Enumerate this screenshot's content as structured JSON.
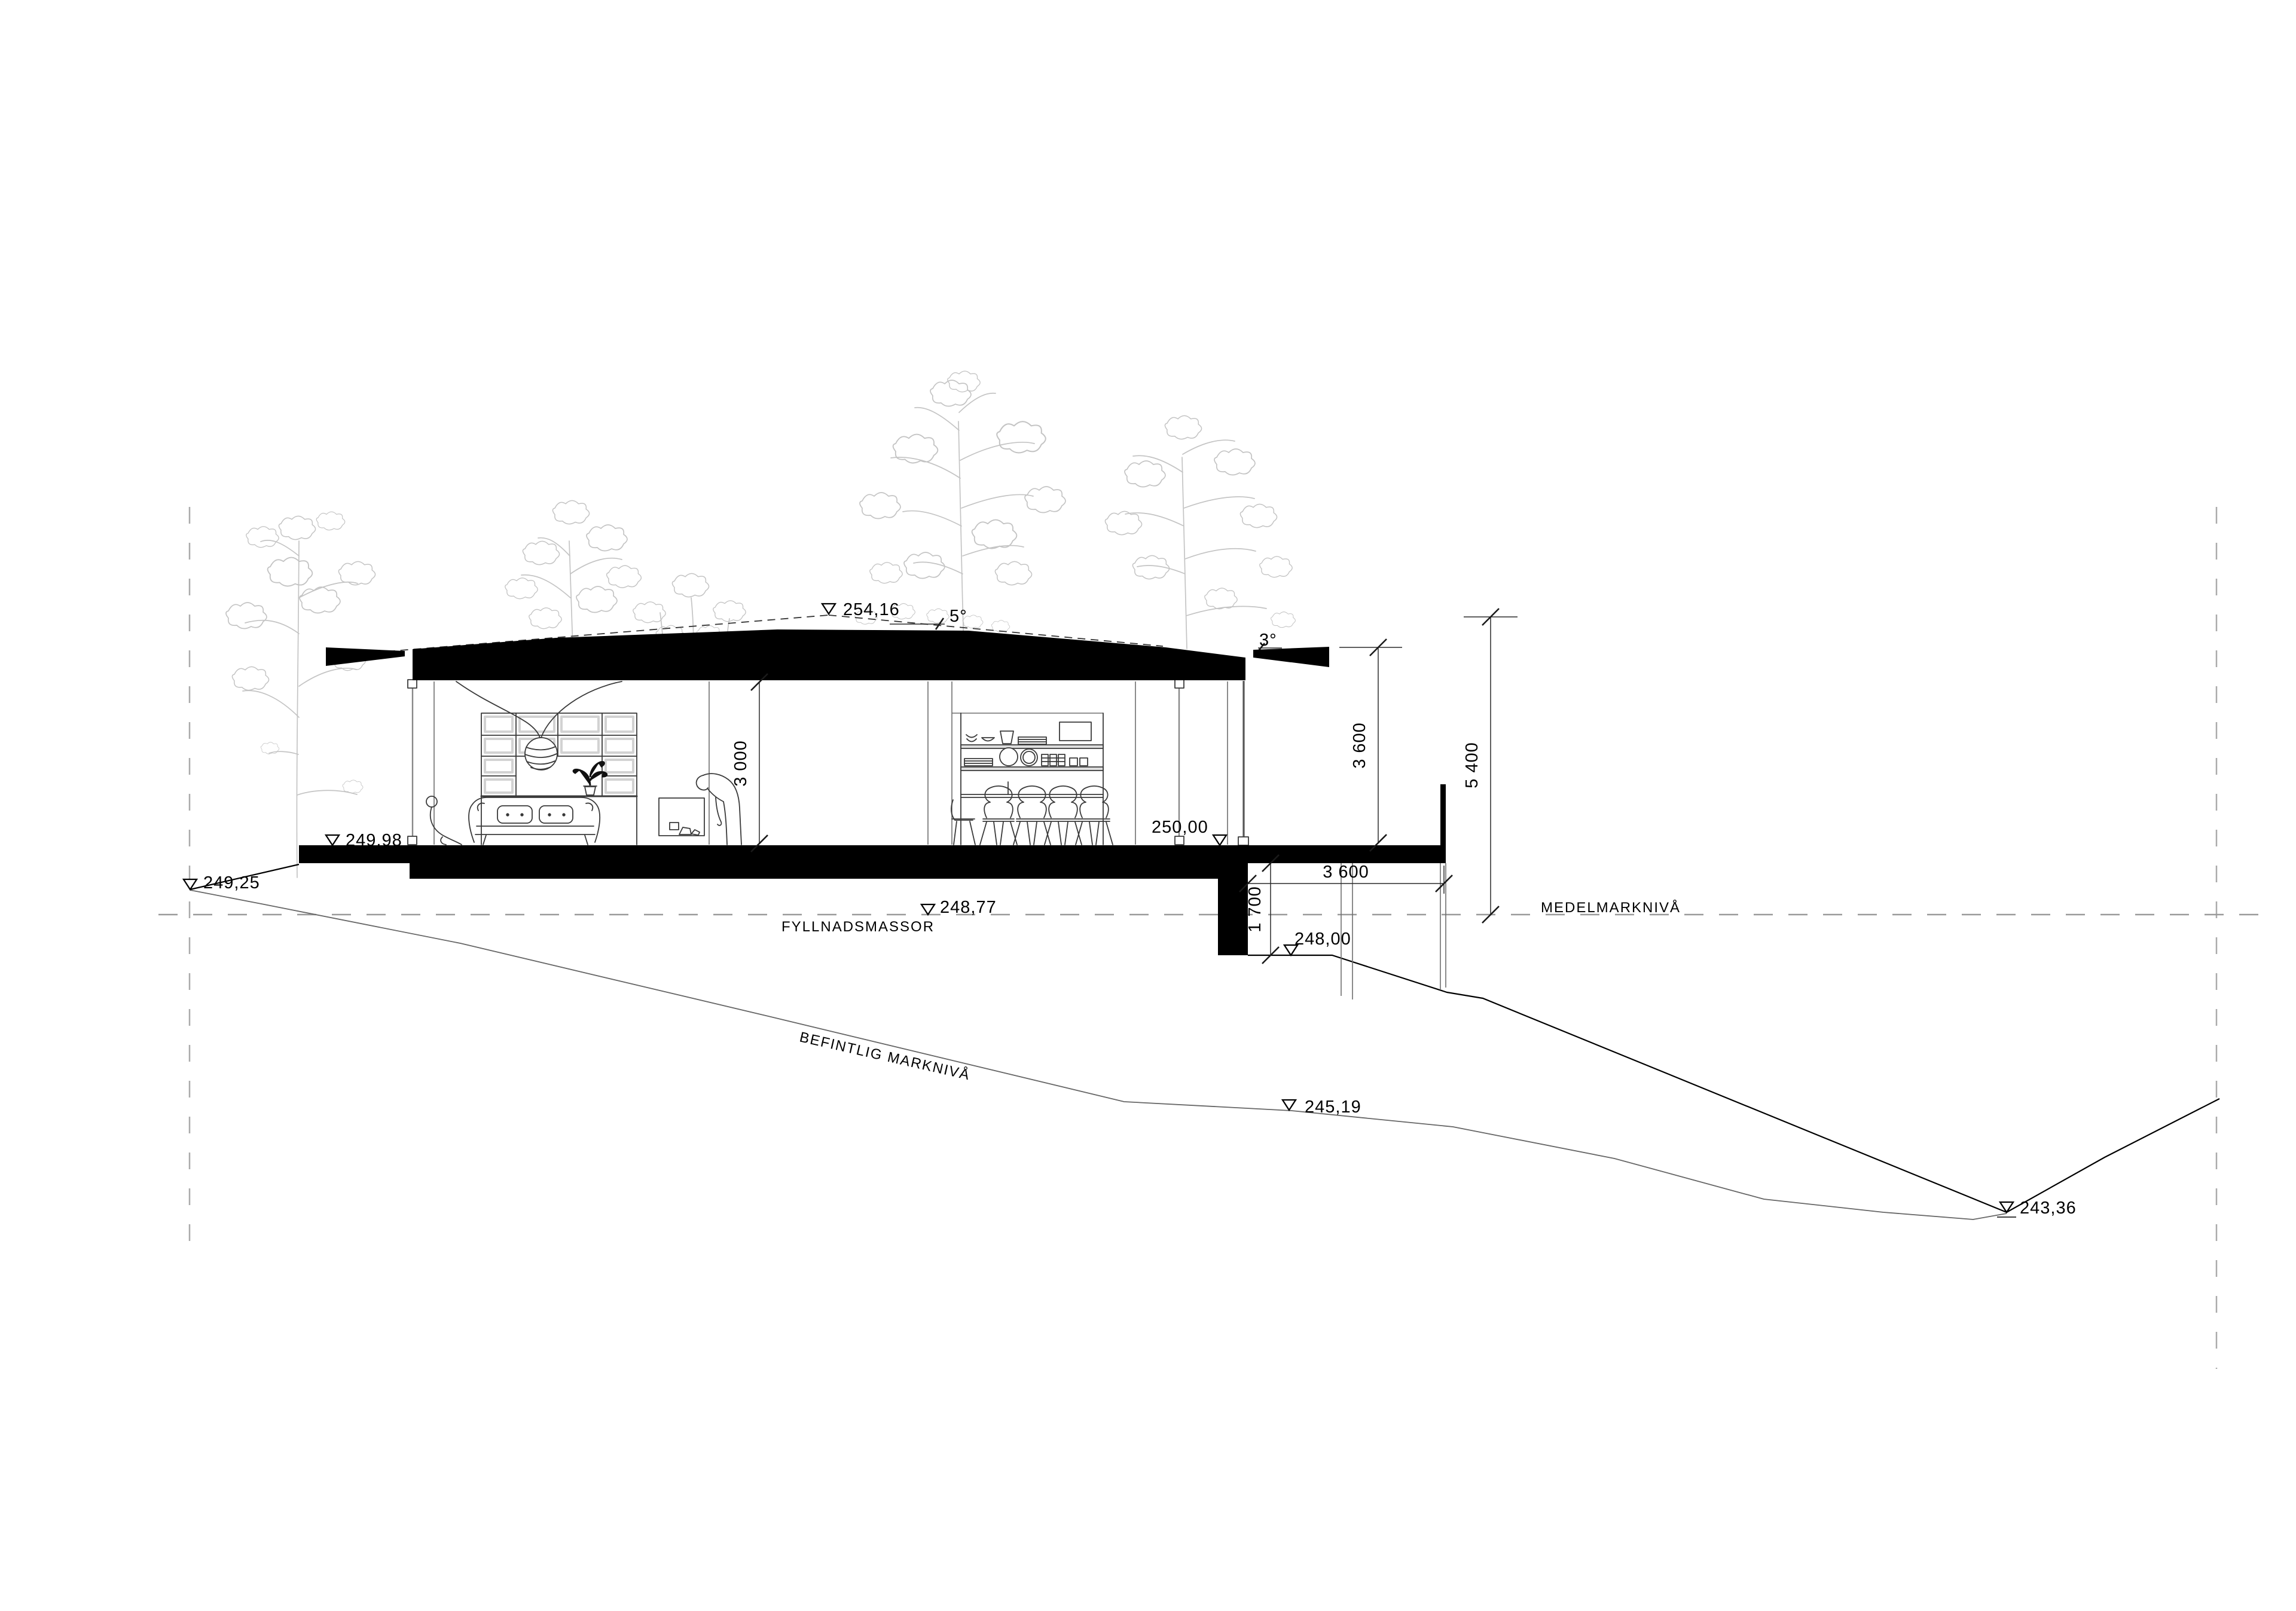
{
  "drawing": {
    "title": "house-section",
    "annotations": {
      "peak_level": "254,16",
      "main_roof_angle": "5°",
      "overhang_roof_angle": "3°",
      "interior_height": "3 000",
      "parapet_height": "3 600",
      "total_height": "5 400",
      "deck_length": "3 600",
      "deck_to_ground_height": "1 700",
      "floor_level": "250,00",
      "terrace_level": "249,98",
      "ground_level_west": "249,25",
      "mean_ground_level": "248,77",
      "ground_below_deck_level": "248,00",
      "slope_level": "245,19",
      "low_point_level": "243,36"
    },
    "ground_labels": {
      "fill_masses": "FYLLNADSMASSOR",
      "mean_ground": "MEDELMARKNIVÅ",
      "existing_ground": "BEFINTLIG MARKNIVÅ"
    },
    "colors": {
      "ink": "#000000",
      "section_fill": "#000000",
      "existing_ground_line": "#666666",
      "dashed_reference": "#9a9a9a",
      "trees": "#c4c4c4",
      "background": "#ffffff"
    }
  }
}
